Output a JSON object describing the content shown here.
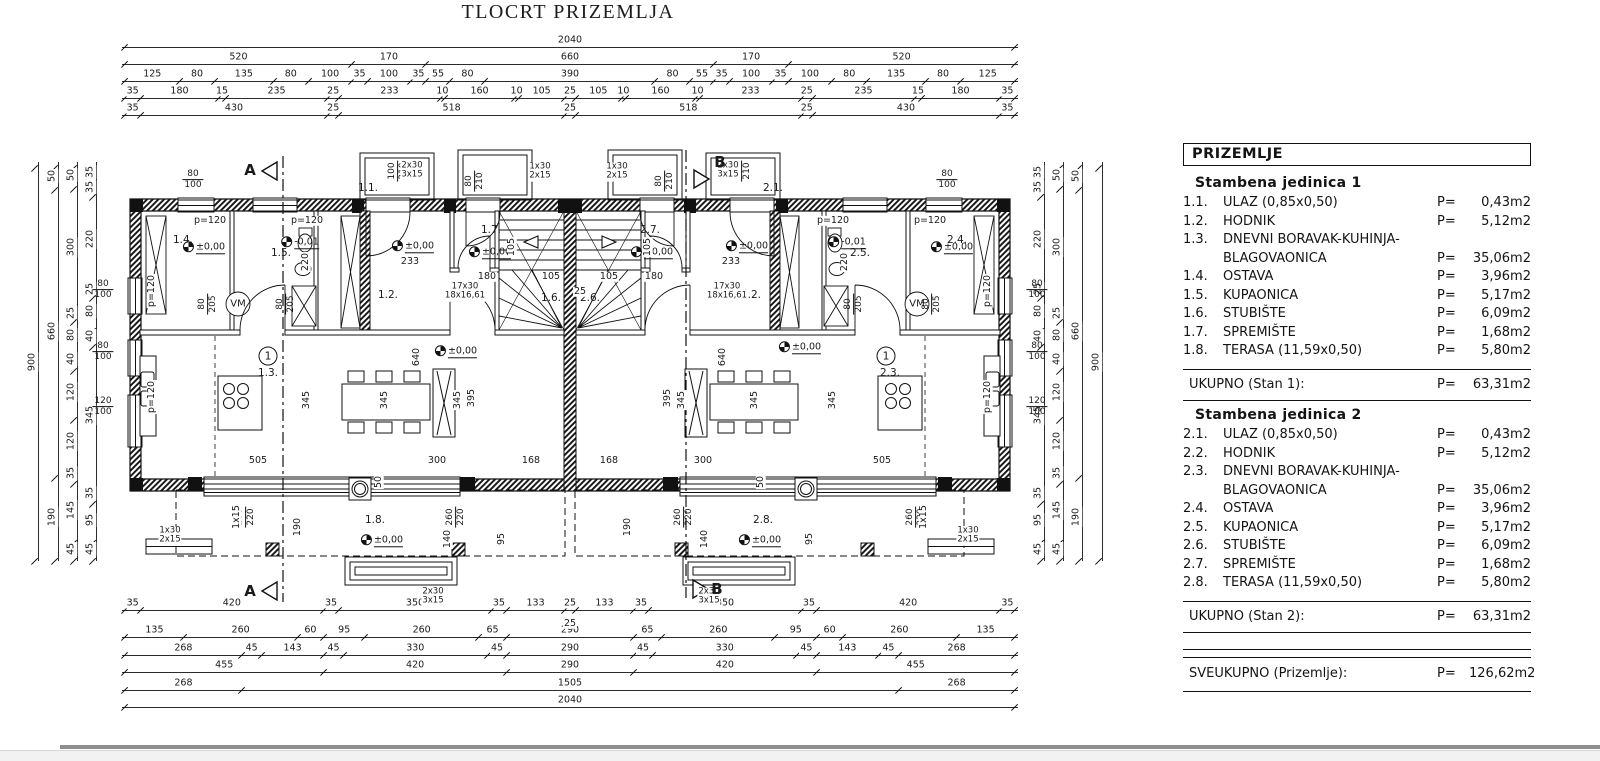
{
  "title": "TLOCRT PRIZEMLJA",
  "legend": {
    "header": "PRIZEMLJE",
    "units": [
      {
        "title": "Stambena jedinica 1",
        "rows": [
          {
            "no": "1.1.",
            "name": "ULAZ (0,85x0,50)",
            "p": "P=",
            "val": "0,43m2"
          },
          {
            "no": "1.2.",
            "name": "HODNIK",
            "p": "P=",
            "val": "5,12m2"
          },
          {
            "no": "1.3.",
            "name": "DNEVNI BORAVAK-KUHINJA-",
            "p": "",
            "val": ""
          },
          {
            "no": "",
            "name": "BLAGOVAONICA",
            "p": "P=",
            "val": "35,06m2"
          },
          {
            "no": "1.4.",
            "name": "OSTAVA",
            "p": "P=",
            "val": "3,96m2"
          },
          {
            "no": "1.5.",
            "name": "KUPAONICA",
            "p": "P=",
            "val": "5,17m2"
          },
          {
            "no": "1.6.",
            "name": "STUBIŠTE",
            "p": "P=",
            "val": "6,09m2"
          },
          {
            "no": "1.7.",
            "name": "SPREMIŠTE",
            "p": "P=",
            "val": "1,68m2"
          },
          {
            "no": "1.8.",
            "name": "TERASA (11,59x0,50)",
            "p": "P=",
            "val": "5,80m2"
          }
        ],
        "total_label": "UKUPNO (Stan 1):",
        "total_p": "P=",
        "total_val": "63,31m2"
      },
      {
        "title": "Stambena jedinica 2",
        "rows": [
          {
            "no": "2.1.",
            "name": "ULAZ (0,85x0,50)",
            "p": "P=",
            "val": "0,43m2"
          },
          {
            "no": "2.2.",
            "name": "HODNIK",
            "p": "P=",
            "val": "5,12m2"
          },
          {
            "no": "2.3.",
            "name": "DNEVNI BORAVAK-KUHINJA-",
            "p": "",
            "val": ""
          },
          {
            "no": "",
            "name": "BLAGOVAONICA",
            "p": "P=",
            "val": "35,06m2"
          },
          {
            "no": "2.4.",
            "name": "OSTAVA",
            "p": "P=",
            "val": "3,96m2"
          },
          {
            "no": "2.5.",
            "name": "KUPAONICA",
            "p": "P=",
            "val": "5,17m2"
          },
          {
            "no": "2.6.",
            "name": "STUBIŠTE",
            "p": "P=",
            "val": "6,09m2"
          },
          {
            "no": "2.7.",
            "name": "SPREMIŠTE",
            "p": "P=",
            "val": "1,68m2"
          },
          {
            "no": "2.8.",
            "name": "TERASA (11,59x0,50)",
            "p": "P=",
            "val": "5,80m2"
          }
        ],
        "total_label": "UKUPNO (Stan 2):",
        "total_p": "P=",
        "total_val": "63,31m2"
      }
    ],
    "grand_label": "SVEUKUPNO (Prizemlje):",
    "grand_p": "P=",
    "grand_val": "126,62m2"
  },
  "dims": {
    "h": [
      {
        "y": 47,
        "x1": 125,
        "x2": 1015,
        "segs": [
          2040
        ]
      },
      {
        "y": 64,
        "x1": 125,
        "x2": 1015,
        "segs": [
          520,
          170,
          660,
          170,
          520
        ]
      },
      {
        "y": 81,
        "x1": 125,
        "x2": 1015,
        "segs": [
          125,
          80,
          135,
          80,
          100,
          35,
          100,
          35,
          55,
          80,
          390,
          80,
          55,
          35,
          100,
          35,
          100,
          80,
          135,
          80,
          125
        ]
      },
      {
        "y": 98,
        "x1": 125,
        "x2": 1015,
        "segs": [
          35,
          180,
          15,
          235,
          25,
          233,
          10,
          160,
          10,
          105,
          25,
          105,
          10,
          160,
          10,
          233,
          25,
          235,
          15,
          180,
          35
        ]
      },
      {
        "y": 115,
        "x1": 125,
        "x2": 1015,
        "segs": [
          35,
          430,
          25,
          518,
          25,
          518,
          25,
          430,
          35
        ]
      },
      {
        "y": 610,
        "x1": 125,
        "x2": 1015,
        "segs": [
          35,
          420,
          35,
          350,
          35,
          133,
          25,
          133,
          35,
          350,
          35,
          420,
          35
        ]
      },
      {
        "y": 637,
        "x1": 125,
        "x2": 1015,
        "segs": [
          135,
          260,
          60,
          95,
          260,
          65,
          290,
          65,
          260,
          95,
          60,
          260,
          135
        ]
      },
      {
        "y": 655,
        "x1": 125,
        "x2": 1015,
        "segs": [
          268,
          45,
          143,
          45,
          330,
          45,
          290,
          45,
          330,
          45,
          143,
          45,
          268
        ]
      },
      {
        "y": 672,
        "x1": 125,
        "x2": 1015,
        "segs": [
          455,
          420,
          290,
          420,
          455
        ]
      },
      {
        "y": 690,
        "x1": 125,
        "x2": 1015,
        "segs": [
          268,
          1505,
          268
        ]
      },
      {
        "y": 707,
        "x1": 125,
        "x2": 1015,
        "segs": [
          2040
        ]
      }
    ],
    "v": [
      {
        "x": 38,
        "y1": 165,
        "y2": 558,
        "segs": [
          900
        ]
      },
      {
        "x": 58,
        "y1": 165,
        "y2": 558,
        "segs": [
          50,
          660,
          190
        ]
      },
      {
        "x": 77,
        "y1": 165,
        "y2": 558,
        "segs": [
          50,
          300,
          25,
          80,
          40,
          120,
          120,
          35,
          145,
          45
        ]
      },
      {
        "x": 96,
        "y1": 165,
        "y2": 558,
        "segs": [
          35,
          35,
          220,
          25,
          80,
          40,
          345,
          35,
          95,
          45
        ]
      },
      {
        "x": 1102,
        "y1": 165,
        "y2": 558,
        "segs": [
          900
        ]
      },
      {
        "x": 1082,
        "y1": 165,
        "y2": 558,
        "segs": [
          50,
          660,
          190
        ]
      },
      {
        "x": 1063,
        "y1": 165,
        "y2": 558,
        "segs": [
          50,
          300,
          25,
          80,
          40,
          120,
          120,
          35,
          145,
          45
        ]
      },
      {
        "x": 1044,
        "y1": 165,
        "y2": 558,
        "segs": [
          35,
          35,
          220,
          25,
          80,
          40,
          345,
          35,
          95,
          45
        ]
      }
    ]
  },
  "plan_labels": [
    {
      "t": "1.1.",
      "x": 368,
      "y": 189,
      "k": "room"
    },
    {
      "t": "1.2.",
      "x": 388,
      "y": 296,
      "k": "room"
    },
    {
      "t": "1.3.",
      "x": 268,
      "y": 374,
      "k": "room"
    },
    {
      "t": "1.4.",
      "x": 183,
      "y": 241,
      "k": "room"
    },
    {
      "t": "1.5.",
      "x": 281,
      "y": 254,
      "k": "room"
    },
    {
      "t": "1.6.",
      "x": 551,
      "y": 299,
      "k": "room"
    },
    {
      "t": "1.7.",
      "x": 491,
      "y": 231,
      "k": "room"
    },
    {
      "t": "1.8.",
      "x": 375,
      "y": 521,
      "k": "room"
    },
    {
      "t": "2.1.",
      "x": 773,
      "y": 189,
      "k": "room"
    },
    {
      "t": "2.2.",
      "x": 751,
      "y": 296,
      "k": "room"
    },
    {
      "t": "2.3.",
      "x": 890,
      "y": 374,
      "k": "room"
    },
    {
      "t": "2.4.",
      "x": 957,
      "y": 241,
      "k": "room"
    },
    {
      "t": "2.5.",
      "x": 860,
      "y": 254,
      "k": "room"
    },
    {
      "t": "2.6.",
      "x": 590,
      "y": 299,
      "k": "room"
    },
    {
      "t": "2.7.",
      "x": 650,
      "y": 231,
      "k": "room"
    },
    {
      "t": "2.8.",
      "x": 763,
      "y": 521,
      "k": "room"
    },
    {
      "t": "1",
      "x": 268,
      "y": 356,
      "k": "circ"
    },
    {
      "t": "1",
      "x": 886,
      "y": 356,
      "k": "circ"
    },
    {
      "t": "±0,00",
      "x": 204,
      "y": 247,
      "k": "elev"
    },
    {
      "t": "±0,00",
      "x": 413,
      "y": 246,
      "k": "elev"
    },
    {
      "t": "±0,00",
      "x": 490,
      "y": 252,
      "k": "elev"
    },
    {
      "t": "-0,01",
      "x": 300,
      "y": 242,
      "k": "elev"
    },
    {
      "t": "±0,00",
      "x": 456,
      "y": 351,
      "k": "elev"
    },
    {
      "t": "±0,00",
      "x": 382,
      "y": 540,
      "k": "elev"
    },
    {
      "t": "±0,00",
      "x": 747,
      "y": 246,
      "k": "elev"
    },
    {
      "t": "±0,00",
      "x": 652,
      "y": 252,
      "k": "elev"
    },
    {
      "t": "-0,01",
      "x": 847,
      "y": 242,
      "k": "elev"
    },
    {
      "t": "±0,00",
      "x": 800,
      "y": 347,
      "k": "elev"
    },
    {
      "t": "±0,00",
      "x": 952,
      "y": 247,
      "k": "elev"
    },
    {
      "t": "±0,00",
      "x": 760,
      "y": 540,
      "k": "elev"
    },
    {
      "t": "VM",
      "x": 238,
      "y": 304,
      "k": "vm"
    },
    {
      "t": "VM",
      "x": 917,
      "y": 304,
      "k": "vm"
    },
    {
      "t": "80/100",
      "x": 193,
      "y": 180,
      "k": "frac"
    },
    {
      "t": "80/100",
      "x": 947,
      "y": 180,
      "k": "frac"
    },
    {
      "t": "80/100",
      "x": 103,
      "y": 290,
      "k": "frac"
    },
    {
      "t": "80/100",
      "x": 103,
      "y": 352,
      "k": "frac"
    },
    {
      "t": "120/100",
      "x": 103,
      "y": 407,
      "k": "frac"
    },
    {
      "t": "80/100",
      "x": 1037,
      "y": 290,
      "k": "frac"
    },
    {
      "t": "80/100",
      "x": 1037,
      "y": 352,
      "k": "frac"
    },
    {
      "t": "120/100",
      "x": 1037,
      "y": 407,
      "k": "frac"
    },
    {
      "t": "100/210",
      "x": 398,
      "y": 171,
      "k": "fracv"
    },
    {
      "t": "100/210",
      "x": 742,
      "y": 171,
      "k": "fracv"
    },
    {
      "t": "80/210",
      "x": 475,
      "y": 181,
      "k": "fracv"
    },
    {
      "t": "80/210",
      "x": 665,
      "y": 181,
      "k": "fracv"
    },
    {
      "t": "80/205",
      "x": 208,
      "y": 304,
      "k": "fracv"
    },
    {
      "t": "80/205",
      "x": 286,
      "y": 304,
      "k": "fracv"
    },
    {
      "t": "80/205",
      "x": 854,
      "y": 304,
      "k": "fracv"
    },
    {
      "t": "80/205",
      "x": 932,
      "y": 304,
      "k": "fracv"
    },
    {
      "t": "260/220",
      "x": 246,
      "y": 517,
      "k": "fracv"
    },
    {
      "t": "260/220",
      "x": 456,
      "y": 517,
      "k": "fracv"
    },
    {
      "t": "260/220",
      "x": 684,
      "y": 517,
      "k": "fracv"
    },
    {
      "t": "260/220",
      "x": 916,
      "y": 517,
      "k": "fracv"
    },
    {
      "t": "1x30|2x15",
      "x": 540,
      "y": 172,
      "k": "steps"
    },
    {
      "t": "1x30|2x15",
      "x": 617,
      "y": 172,
      "k": "steps"
    },
    {
      "t": "2x30|3x15",
      "x": 412,
      "y": 171,
      "k": "steps"
    },
    {
      "t": "2x30|3x15",
      "x": 728,
      "y": 171,
      "k": "steps"
    },
    {
      "t": "1x30|2x15",
      "x": 170,
      "y": 536,
      "k": "steps"
    },
    {
      "t": "1x30|2x15",
      "x": 968,
      "y": 536,
      "k": "steps"
    },
    {
      "t": "2x30|3x15",
      "x": 433,
      "y": 597,
      "k": "steps"
    },
    {
      "t": "2x30|3x15",
      "x": 709,
      "y": 597,
      "k": "steps"
    },
    {
      "t": "17x30|18x16,61",
      "x": 465,
      "y": 292,
      "k": "steps"
    },
    {
      "t": "17x30|18x16,61",
      "x": 727,
      "y": 292,
      "k": "steps"
    },
    {
      "t": "233",
      "x": 410,
      "y": 262,
      "k": "dim"
    },
    {
      "t": "233",
      "x": 731,
      "y": 262,
      "k": "dim"
    },
    {
      "t": "180",
      "x": 487,
      "y": 277,
      "k": "dim"
    },
    {
      "t": "180",
      "x": 654,
      "y": 277,
      "k": "dim"
    },
    {
      "t": "105",
      "x": 551,
      "y": 277,
      "k": "dim"
    },
    {
      "t": "105",
      "x": 609,
      "y": 277,
      "k": "dim"
    },
    {
      "t": "25",
      "x": 580,
      "y": 292,
      "k": "dim"
    },
    {
      "t": "505",
      "x": 258,
      "y": 461,
      "k": "dim"
    },
    {
      "t": "300",
      "x": 437,
      "y": 461,
      "k": "dim"
    },
    {
      "t": "168",
      "x": 531,
      "y": 461,
      "k": "dim"
    },
    {
      "t": "168",
      "x": 609,
      "y": 461,
      "k": "dim"
    },
    {
      "t": "300",
      "x": 703,
      "y": 461,
      "k": "dim"
    },
    {
      "t": "505",
      "x": 882,
      "y": 461,
      "k": "dim"
    },
    {
      "t": "25",
      "x": 570,
      "y": 624,
      "k": "dim"
    },
    {
      "t": "220",
      "x": 306,
      "y": 262,
      "k": "dimv"
    },
    {
      "t": "220",
      "x": 845,
      "y": 262,
      "k": "dimv"
    },
    {
      "t": "105",
      "x": 512,
      "y": 247,
      "k": "dimv"
    },
    {
      "t": "105",
      "x": 648,
      "y": 247,
      "k": "dimv"
    },
    {
      "t": "345",
      "x": 307,
      "y": 400,
      "k": "dimv"
    },
    {
      "t": "345",
      "x": 385,
      "y": 400,
      "k": "dimv"
    },
    {
      "t": "345",
      "x": 458,
      "y": 400,
      "k": "dimv"
    },
    {
      "t": "395",
      "x": 472,
      "y": 398,
      "k": "dimv"
    },
    {
      "t": "640",
      "x": 417,
      "y": 357,
      "k": "dimv"
    },
    {
      "t": "345",
      "x": 833,
      "y": 400,
      "k": "dimv"
    },
    {
      "t": "345",
      "x": 755,
      "y": 400,
      "k": "dimv"
    },
    {
      "t": "345",
      "x": 682,
      "y": 400,
      "k": "dimv"
    },
    {
      "t": "395",
      "x": 668,
      "y": 398,
      "k": "dimv"
    },
    {
      "t": "640",
      "x": 723,
      "y": 357,
      "k": "dimv"
    },
    {
      "t": "50",
      "x": 379,
      "y": 482,
      "k": "dimv"
    },
    {
      "t": "50",
      "x": 761,
      "y": 482,
      "k": "dimv"
    },
    {
      "t": "190",
      "x": 298,
      "y": 527,
      "k": "dimv"
    },
    {
      "t": "190",
      "x": 628,
      "y": 527,
      "k": "dimv"
    },
    {
      "t": "140",
      "x": 448,
      "y": 539,
      "k": "dimv"
    },
    {
      "t": "140",
      "x": 705,
      "y": 539,
      "k": "dimv"
    },
    {
      "t": "95",
      "x": 502,
      "y": 539,
      "k": "dimv"
    },
    {
      "t": "95",
      "x": 810,
      "y": 539,
      "k": "dimv"
    },
    {
      "t": "1x15",
      "x": 237,
      "y": 517,
      "k": "dimv"
    },
    {
      "t": "1x15",
      "x": 924,
      "y": 517,
      "k": "dimv"
    },
    {
      "t": "p=120",
      "x": 210,
      "y": 221,
      "k": "p"
    },
    {
      "t": "p=120",
      "x": 307,
      "y": 221,
      "k": "p"
    },
    {
      "t": "p=120",
      "x": 833,
      "y": 221,
      "k": "p"
    },
    {
      "t": "p=120",
      "x": 930,
      "y": 221,
      "k": "p"
    },
    {
      "t": "p=120",
      "x": 152,
      "y": 291,
      "k": "pv"
    },
    {
      "t": "p=120",
      "x": 152,
      "y": 397,
      "k": "pv"
    },
    {
      "t": "p=120",
      "x": 988,
      "y": 291,
      "k": "pv"
    },
    {
      "t": "p=120",
      "x": 988,
      "y": 397,
      "k": "pv"
    },
    {
      "t": "A",
      "x": 250,
      "y": 170,
      "k": "sec"
    },
    {
      "t": "A",
      "x": 250,
      "y": 591,
      "k": "sec"
    },
    {
      "t": "B",
      "x": 720,
      "y": 162,
      "k": "sec"
    },
    {
      "t": "B",
      "x": 717,
      "y": 589,
      "k": "sec"
    }
  ],
  "colors": {
    "line": "#1a1a1a",
    "paper": "#ffffff",
    "taskbar": "#f2f2f2",
    "bar": "#8f8f8f"
  }
}
